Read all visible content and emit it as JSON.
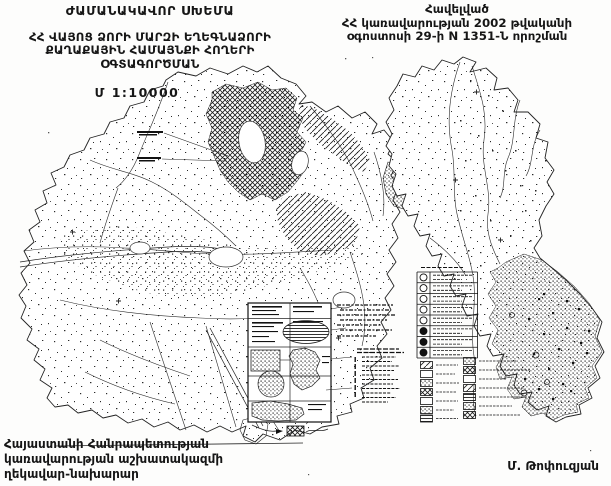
{
  "colors": {
    "ink": "#1a1a1a",
    "paper": "#fdfdfc"
  },
  "header_left": {
    "title": "ԺԱՄԱՆԱԿԱՎՈՐ ՍԽԵՄԱ",
    "subtitle_lines": [
      "ՀՀ ՎԱՅՈՑ ՁՈՐԻ ՄԱՐԶԻ ԵՂԵԳՆԱՁՈՐԻ",
      "ՔԱՂԱՔԱՅԻՆ ՀԱՄԱՅՆՔԻ ՀՈՂԵՐԻ",
      "ՕԳՏԱԳՈՐԾՄԱՆ"
    ],
    "scale": "Մ 1:10000"
  },
  "header_right": {
    "lines": [
      "Հավելված",
      "ՀՀ կառավարության 2002 թվականի",
      "օգոստոսի 29-ի N 1351-Ն որոշման"
    ]
  },
  "footer": {
    "office_lines": [
      "Հայաստանի Հանրապետության",
      "կառավարության աշխատակազմի",
      "ղեկավար-նախարար"
    ],
    "signature": "Մ. Թոփուզյան"
  }
}
